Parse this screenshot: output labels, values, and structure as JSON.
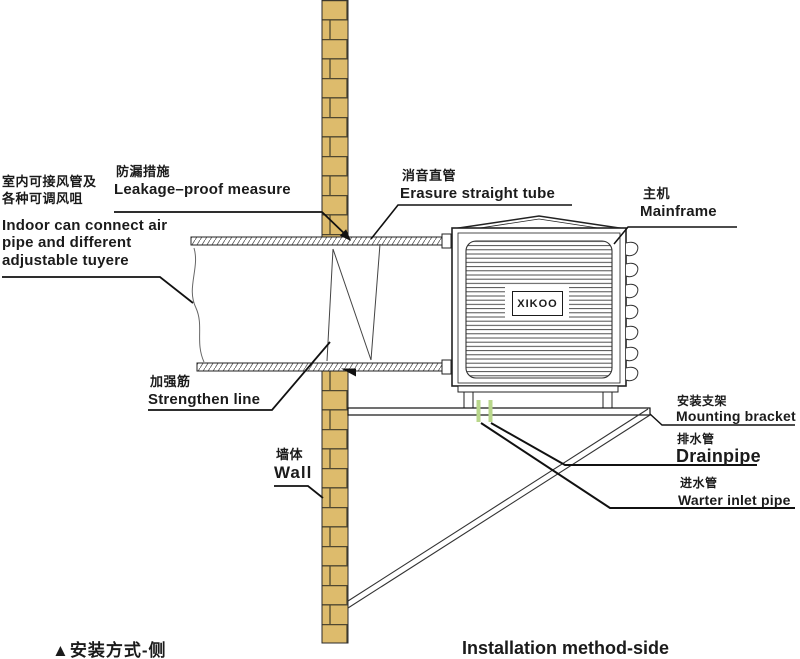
{
  "diagram": {
    "caption_left": "▲安装方式-侧",
    "caption_right": "Installation method-side",
    "brand": "XIKOO"
  },
  "colors": {
    "brick": "#ddbb6c",
    "mortar": "#4f4730",
    "pipe_green": "#b9d78b",
    "pipe_green_stroke": "#7fae54",
    "outline": "#1b1b1b"
  },
  "labels": {
    "indoor": {
      "zh": "室内可接风管及\n各种可调风咀",
      "en": "Indoor can connect air\npipe and different\nadjustable tuyere"
    },
    "leakage": {
      "zh": "防漏措施",
      "en": "Leakage–proof measure"
    },
    "erasure": {
      "zh": "消音直管",
      "en": "Erasure straight tube"
    },
    "mainframe": {
      "zh": "主机",
      "en": "Mainframe"
    },
    "strengthen": {
      "zh": "加强筋",
      "en": "Strengthen line"
    },
    "wall": {
      "zh": "墙体",
      "en": "Wall"
    },
    "mounting": {
      "zh": "安装支架",
      "en": "Mounting bracket"
    },
    "drainpipe": {
      "zh": "排水管",
      "en": "Drainpipe"
    },
    "water_inlet": {
      "zh": "进水管",
      "en": "Warter inlet pipe"
    }
  }
}
